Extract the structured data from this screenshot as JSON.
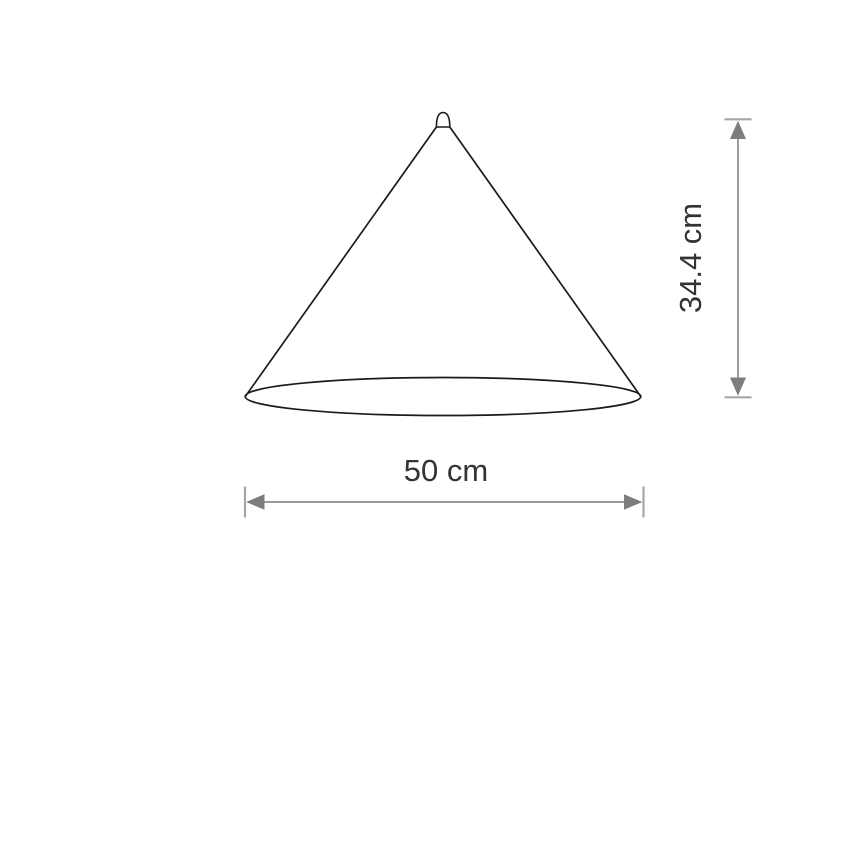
{
  "diagram": {
    "labels": {
      "width": "50 cm",
      "height": "34.4 cm"
    },
    "colors": {
      "background": "#ffffff",
      "cone_outline": "#1b1b1b",
      "dimension_line": "#999999",
      "dimension_cap": "#a6a6a6",
      "arrowhead": "#7d7d7d",
      "label_text": "#333333"
    }
  }
}
